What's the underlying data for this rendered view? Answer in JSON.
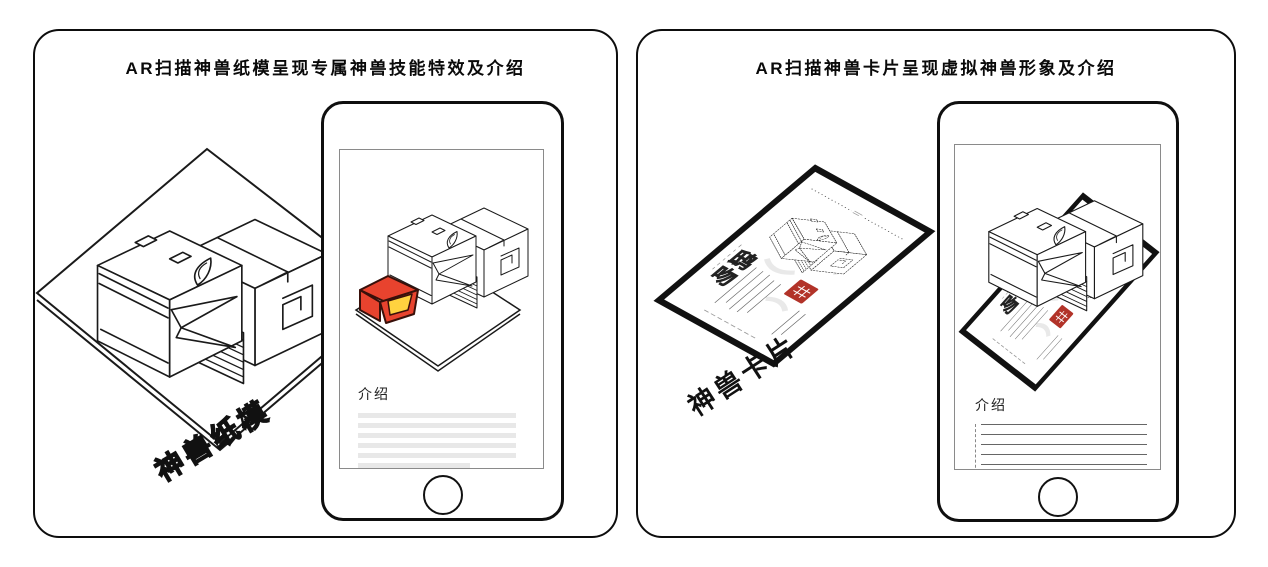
{
  "left_panel": {
    "title": "AR扫描神兽纸模呈现专属神兽技能特效及介绍",
    "platform_label": "神兽纸模",
    "phone_screen": {
      "intro_heading": "介绍"
    }
  },
  "right_panel": {
    "title": "AR扫描神兽卡片呈现虚拟神兽形象及介绍",
    "card_label": "神兽卡片",
    "card": {
      "beast_name": "鸱吻"
    },
    "phone_screen": {
      "intro_heading": "介绍"
    }
  },
  "colors": {
    "effect_red": "#E8432E",
    "effect_yellow": "#FFD23F",
    "seal_red": "#B23329",
    "line_black": "#1A1A1A"
  }
}
